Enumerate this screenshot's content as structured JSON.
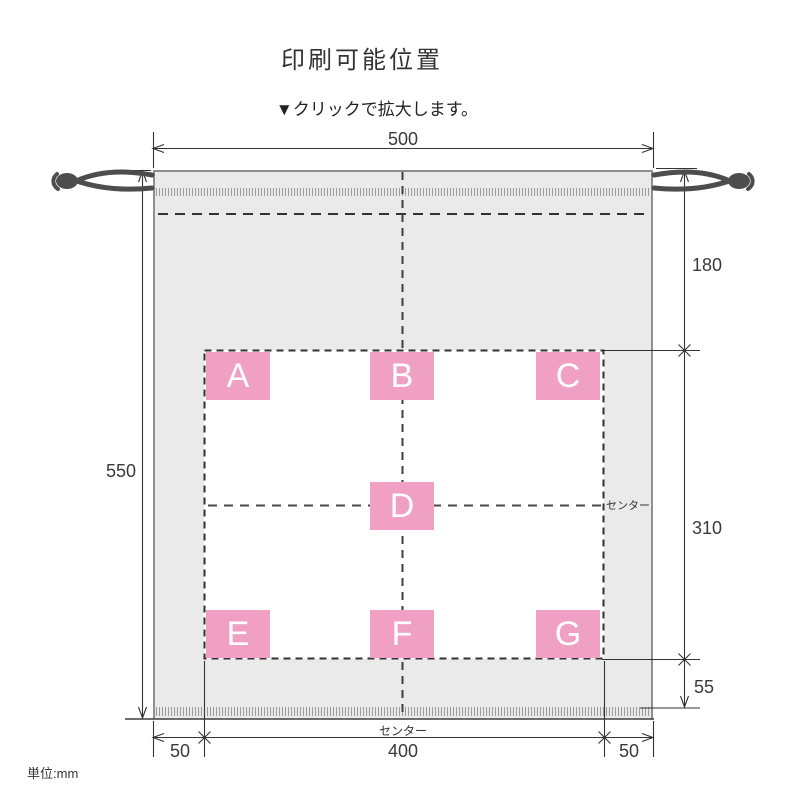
{
  "page": {
    "title": "印刷可能位置",
    "subtitle": "▼クリックで拡大します。",
    "unit_note": "単位:mm"
  },
  "diagram": {
    "print_labels": [
      "A",
      "B",
      "C",
      "D",
      "E",
      "F",
      "G"
    ],
    "dims": {
      "bag_width": "500",
      "bag_height": "550",
      "top_to_print": "180",
      "print_height": "310",
      "print_to_bottom": "55",
      "left_margin": "50",
      "print_width": "400",
      "right_margin": "50"
    },
    "center_label_right": "センター",
    "center_label_bottom": "センター",
    "colors": {
      "bag_fill": "#eaeaea",
      "bag_border": "#8f8f8f",
      "print_spot_pink": "#f0a1c3",
      "line": "#333333",
      "string": "#4d4d4d"
    }
  }
}
